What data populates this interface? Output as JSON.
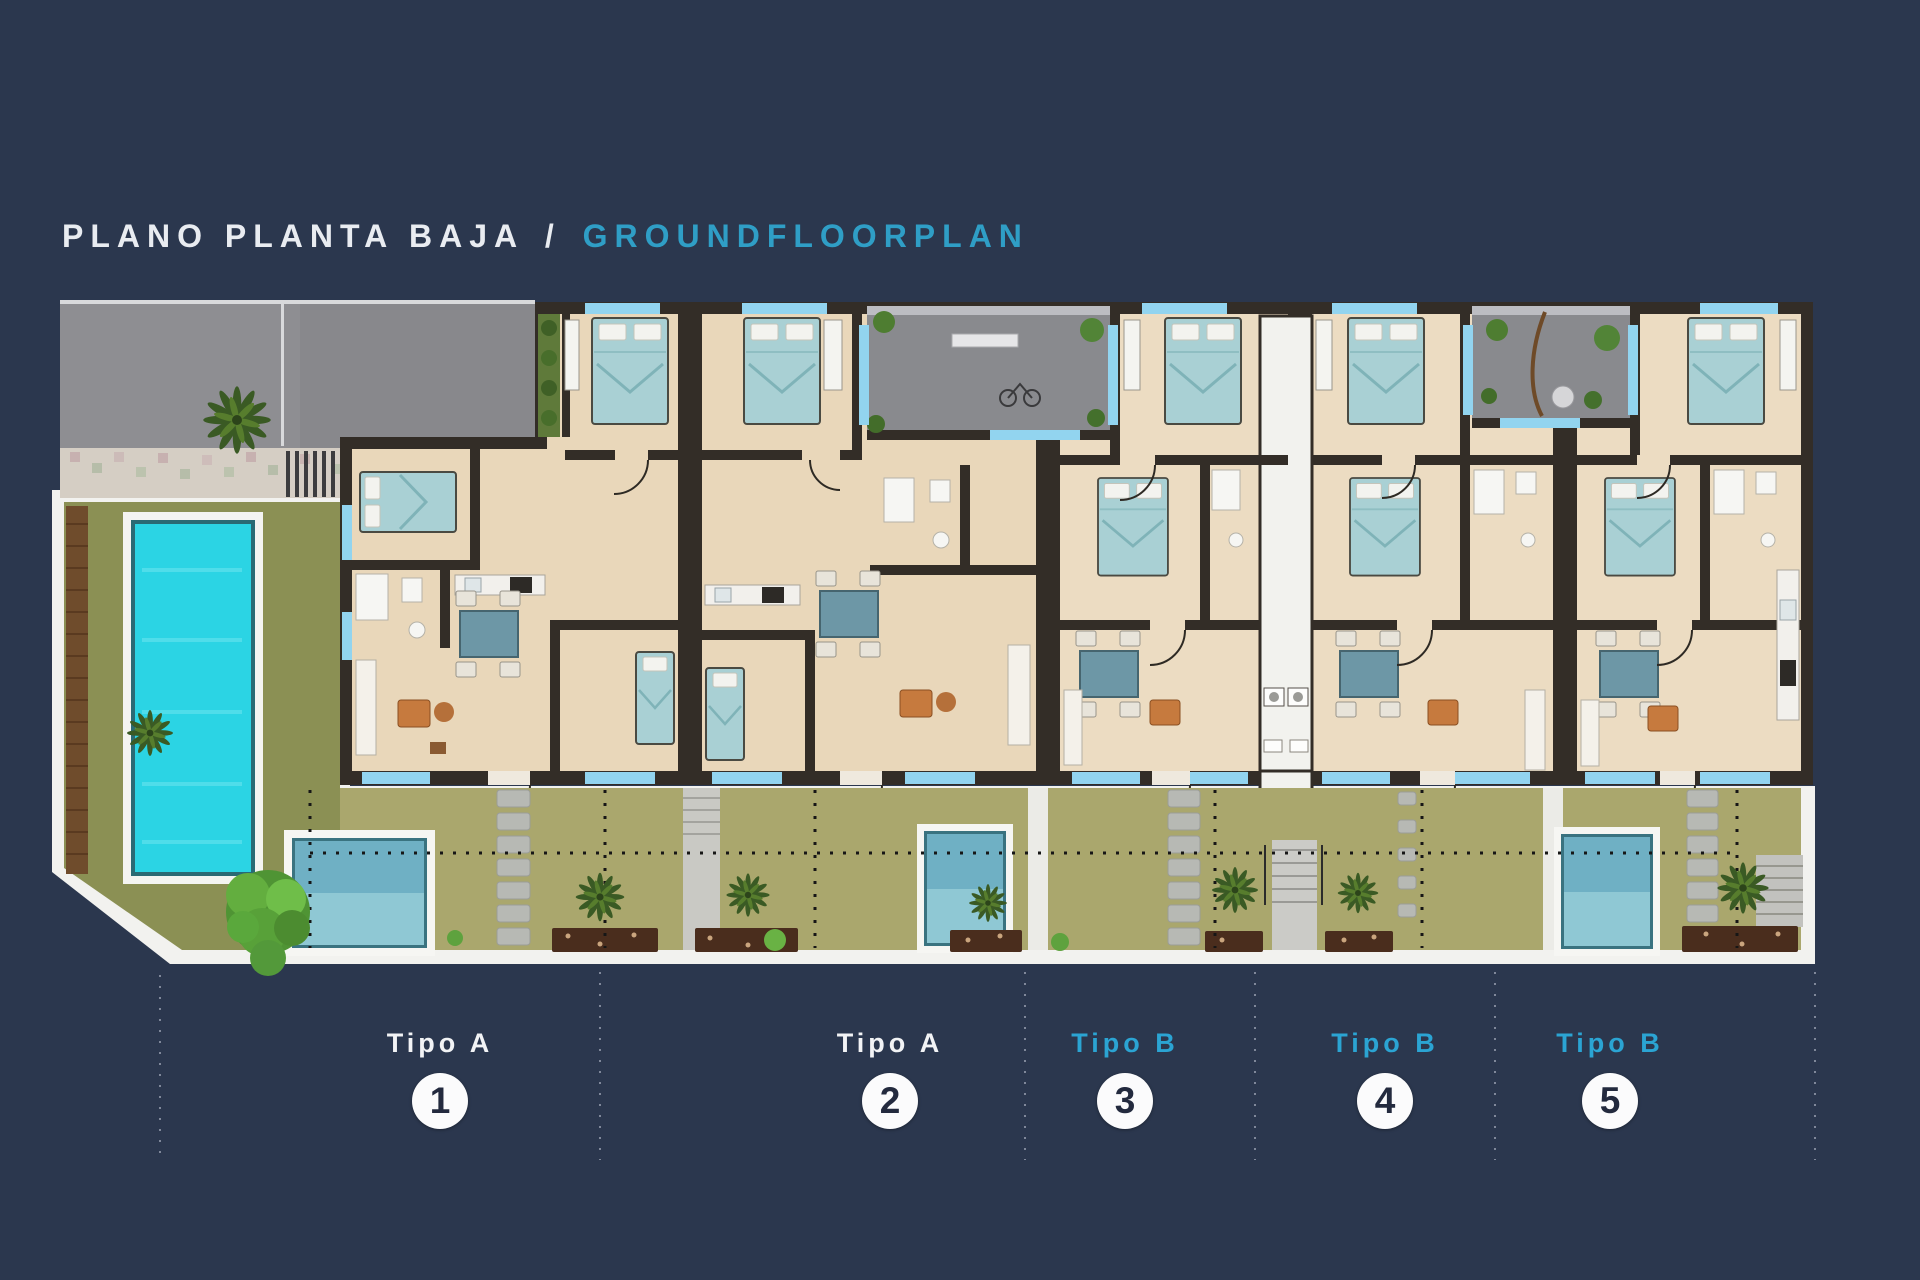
{
  "title": {
    "left": "PLANO PLANTA BAJA",
    "separator": "/",
    "right": "GROUNDFLOORPLAN"
  },
  "floor_plan": {
    "name": "ground-floor-site-plan",
    "units": [
      {
        "label": "Tipo A",
        "number": "1",
        "type": "A",
        "label_color": "#f2f3f5"
      },
      {
        "label": "Tipo A",
        "number": "2",
        "type": "A",
        "label_color": "#f2f3f5"
      },
      {
        "label": "Tipo B",
        "number": "3",
        "type": "B",
        "label_color": "#2ba4d3"
      },
      {
        "label": "Tipo B",
        "number": "4",
        "type": "B",
        "label_color": "#2ba4d3"
      },
      {
        "label": "Tipo B",
        "number": "5",
        "type": "B",
        "label_color": "#2ba4d3"
      }
    ],
    "elements": [
      "driveway",
      "communal-pool",
      "left-garden",
      "palm-trees",
      "entry-courtyards",
      "private-plunge-pools",
      "rear-gardens",
      "stepping-stones",
      "stairs",
      "terrace-windows"
    ]
  },
  "colors": {
    "background": "#2b374e",
    "title_primary": "#e9ecf1",
    "title_accent": "#2f9ec6",
    "type_a_label": "#f2f3f5",
    "type_b_label": "#2ba4d3",
    "circle_fill": "#fbfbfc",
    "circle_number": "#232a3e",
    "wall": "#332d27",
    "floor": "#e9d7ba",
    "bed": "#a9d0d4",
    "window": "#92d4ef",
    "communal_pool": "#2bd4e4",
    "plunge_pool": "#6fb0c4",
    "lawn_left": "#8b9054",
    "lawn_right": "#aaa76d",
    "patio": "#898a8e",
    "driveway": "#8e8e92"
  }
}
